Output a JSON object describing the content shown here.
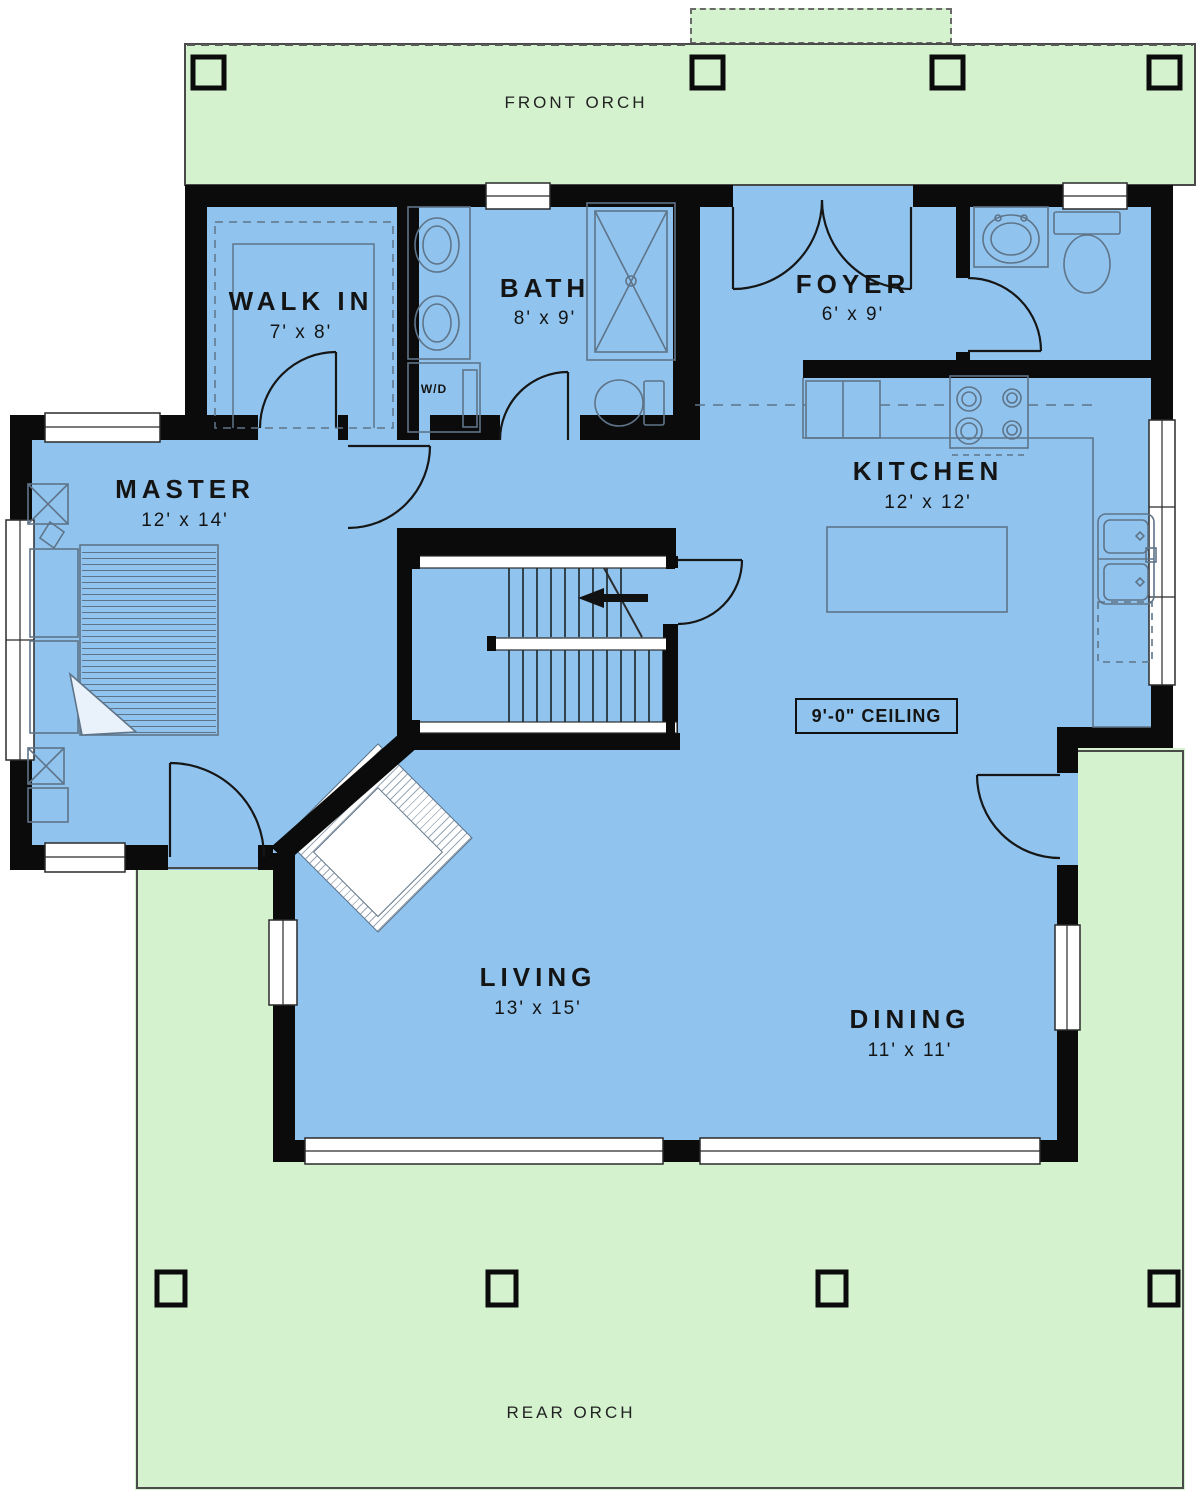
{
  "plan": {
    "front_porch_label": "FRONT ORCH",
    "rear_porch_label": "REAR ORCH",
    "ceiling_note": "9'-0\" CEILING",
    "washer_dryer_label": "W/D",
    "rooms": {
      "master": {
        "name": "MASTER",
        "dims": "12' x 14'"
      },
      "walk_in": {
        "name": "WALK IN",
        "dims": "7' x 8'"
      },
      "bath": {
        "name": "BATH",
        "dims": "8' x 9'"
      },
      "foyer": {
        "name": "FOYER",
        "dims": "6' x 9'"
      },
      "kitchen": {
        "name": "KITCHEN",
        "dims": "12' x 12'"
      },
      "living": {
        "name": "LIVING",
        "dims": "13' x 15'"
      },
      "dining": {
        "name": "DINING",
        "dims": "11' x 11'"
      }
    },
    "colors": {
      "porch_green": "#d5f2cf",
      "floor_blue": "#90c4ef",
      "wall_black": "#0b0b0b",
      "fixture_line": "#5f7488"
    }
  }
}
